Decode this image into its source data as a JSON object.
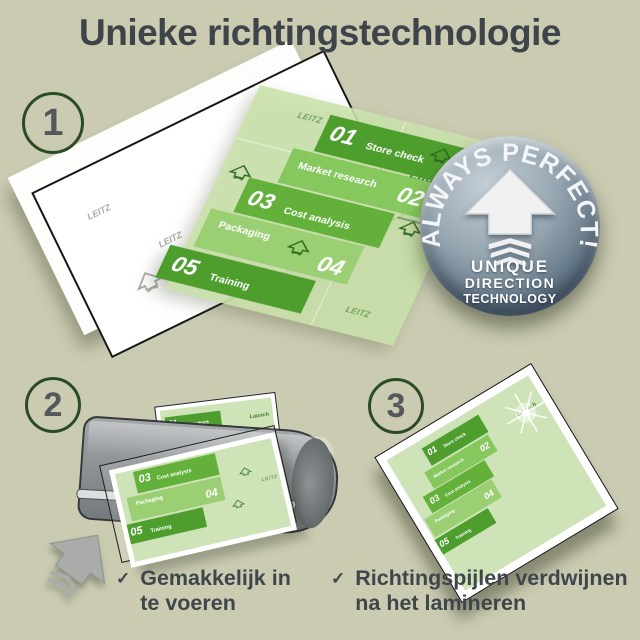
{
  "page": {
    "title": "Unieke richtingstechnologie"
  },
  "step_numbers": [
    "1",
    "2",
    "3"
  ],
  "badge": {
    "curved_text": "ALWAYS PERFECT!",
    "line1": "UNIQUE",
    "line2": "DIRECTION",
    "line3": "TECHNOLOGY"
  },
  "infographic": {
    "launch_label": "Launch",
    "watermark": "LEITZ",
    "boxes": [
      {
        "number": "01",
        "label": "Store check"
      },
      {
        "number": "02",
        "label": "Market research"
      },
      {
        "number": "03",
        "label": "Cost analysis"
      },
      {
        "number": "04",
        "label": "Packaging"
      },
      {
        "number": "05",
        "label": "Training"
      }
    ]
  },
  "bullets": [
    {
      "check": "✓",
      "line1": "Gemakkelijk in",
      "line2": "te voeren"
    },
    {
      "check": "✓",
      "line1": "Richtingspijlen verdwijnen",
      "line2": "na het lamineren"
    }
  ],
  "colors": {
    "background": "#cacbb1",
    "title_text": "#3e454a",
    "green_dark": "#4d9e2d",
    "green_mid": "#63b13a",
    "green_light": "#86c75e",
    "green_pale": "#9bcf74",
    "pouch_green": "#cfe3b8",
    "badge_blue_gray": "#5d7181",
    "laminator_gray": "#8a8f92",
    "circle_border_green": "#2a4c24"
  }
}
